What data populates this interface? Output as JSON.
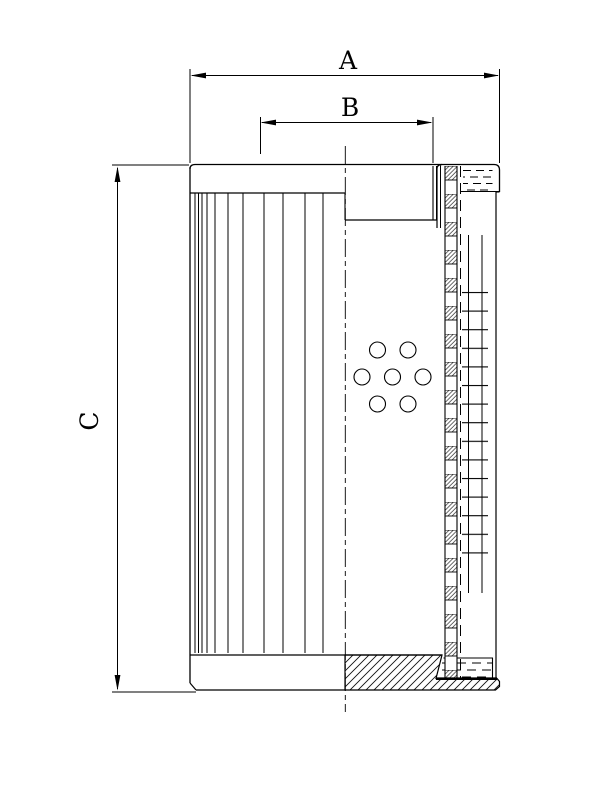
{
  "drawing": {
    "background_color": "#ffffff",
    "line_color": "#000000",
    "labels": {
      "dim_a": "A",
      "dim_b": "B",
      "dim_c": "C"
    },
    "perforation_hole_count": 7
  }
}
